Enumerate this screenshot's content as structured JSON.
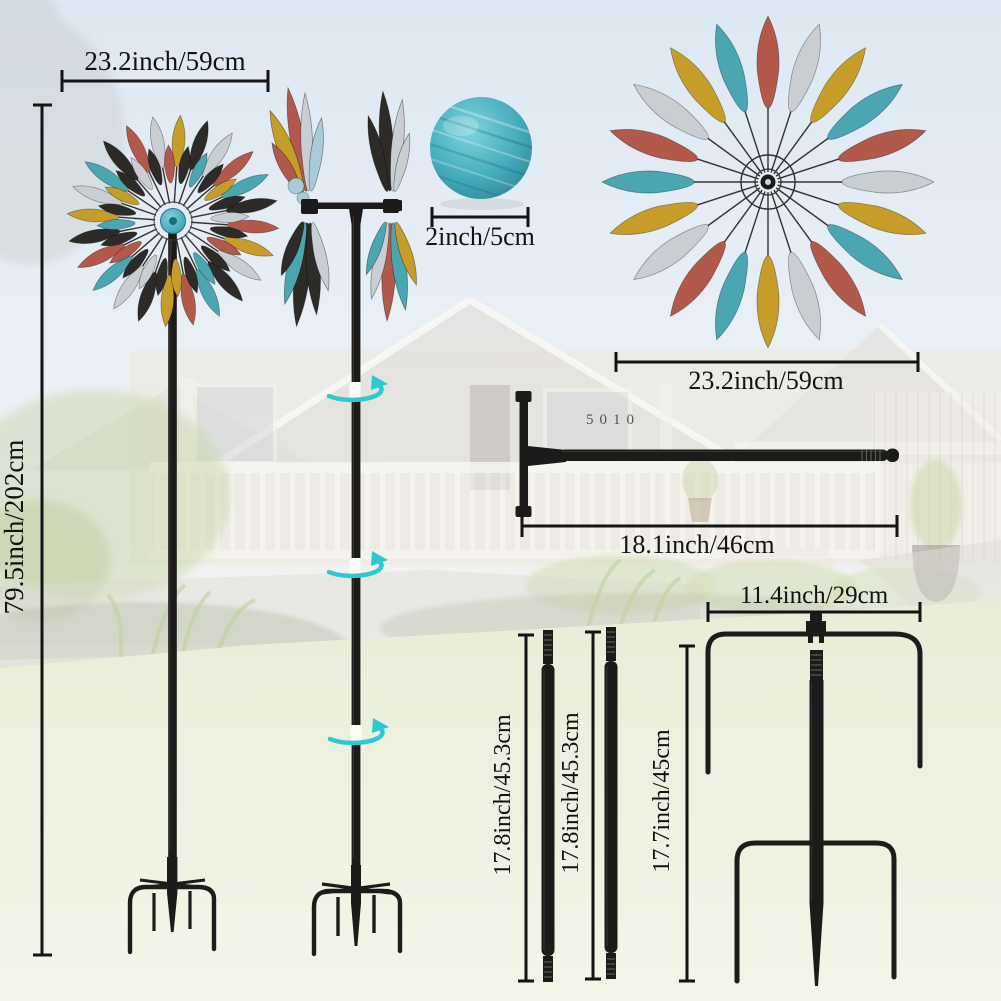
{
  "dims": {
    "left_width": "23.2inch/59cm",
    "total_height": "79.5inch/202cm",
    "ball": "2inch/5cm",
    "right_width": "23.2inch/59cm",
    "rod": "18.1inch/46cm",
    "stake_width": "11.4inch/29cm",
    "pole_a": "17.8inch/45.3cm",
    "pole_b": "17.8inch/45.3cm",
    "stake_height": "17.7inch/45cm"
  },
  "background": {
    "house_number": "5010"
  },
  "colors": {
    "petal_red": "#b2594b",
    "petal_teal": "#4aa7b2",
    "petal_gold": "#c79d2a",
    "petal_silver": "#c9ced3",
    "petal_black": "#2d2b28",
    "petal_lightblue": "#a9cbd8",
    "hub_teal": "#3eafc3",
    "ball_teal": "#3ba7b8",
    "rotation_arrow_cyan": "#2cc8d4",
    "metal_black": "#1c1b19",
    "dimension_black": "#141414"
  },
  "spinners": {
    "left": {
      "cx": 173,
      "cy": 221,
      "rings": [
        {
          "count": 24,
          "start": 4,
          "tip": 106,
          "len": 52,
          "w": 7.5,
          "spoke_inner": 18,
          "spoke_outer": 100,
          "colors": [
            "gold",
            "black",
            "silver",
            "red",
            "teal",
            "black",
            "red",
            "gold",
            "silver",
            "black",
            "teal",
            "red",
            "gold",
            "black",
            "silver",
            "teal",
            "red",
            "black",
            "gold",
            "silver",
            "teal",
            "black",
            "red",
            "silver"
          ]
        },
        {
          "count": 24,
          "start": 11.5,
          "tip": 76,
          "len": 38,
          "w": 6,
          "spoke_inner": 0,
          "spoke_outer": 0,
          "colors": [
            "black",
            "teal",
            "black",
            "gold",
            "black",
            "silver",
            "black",
            "red",
            "black",
            "teal",
            "black",
            "gold",
            "black",
            "silver",
            "black",
            "red",
            "black",
            "teal",
            "black",
            "gold",
            "black",
            "silver",
            "black",
            "red"
          ]
        }
      ]
    },
    "right": {
      "cx": 768,
      "cy": 182,
      "rings": [
        {
          "count": 20,
          "start": 0,
          "tip": 166,
          "len": 92,
          "w": 13,
          "spoke_inner": 10,
          "spoke_outer": 158,
          "colors": [
            "red",
            "silver",
            "gold",
            "teal"
          ]
        }
      ]
    }
  },
  "side_rotors": [
    {
      "cx": 309,
      "cy": 207,
      "leaves": [
        {
          "a": -10,
          "l": 105,
          "w": 8,
          "c": "red"
        },
        {
          "a": -22,
          "l": 88,
          "w": 9,
          "c": "gold"
        },
        {
          "a": -2,
          "l": 98,
          "w": 7,
          "c": "silver"
        },
        {
          "a": 8,
          "l": 74,
          "w": 7,
          "c": "lightblue"
        },
        {
          "a": -30,
          "l": 58,
          "w": 7,
          "c": "red"
        },
        {
          "a": 186,
          "l": 104,
          "w": 9,
          "c": "black"
        },
        {
          "a": 176,
          "l": 92,
          "w": 8,
          "c": "black"
        },
        {
          "a": 194,
          "l": 84,
          "w": 8,
          "c": "teal"
        },
        {
          "a": 167,
          "l": 70,
          "w": 7,
          "c": "silver"
        },
        {
          "a": 202,
          "l": 58,
          "w": 7,
          "c": "black"
        }
      ],
      "dots": [
        {
          "x": 296,
          "y": 186,
          "r": 8
        },
        {
          "x": 303,
          "y": 198,
          "r": 6
        }
      ]
    },
    {
      "cx": 391,
      "cy": 207,
      "leaves": [
        {
          "a": -4,
          "l": 100,
          "w": 8,
          "c": "black"
        },
        {
          "a": 6,
          "l": 92,
          "w": 7,
          "c": "silver"
        },
        {
          "a": -14,
          "l": 78,
          "w": 7,
          "c": "black"
        },
        {
          "a": 14,
          "l": 60,
          "w": 6,
          "c": "silver"
        },
        {
          "a": 182,
          "l": 98,
          "w": 8,
          "c": "red"
        },
        {
          "a": 172,
          "l": 88,
          "w": 8,
          "c": "teal"
        },
        {
          "a": 192,
          "l": 78,
          "w": 7,
          "c": "silver"
        },
        {
          "a": 162,
          "l": 66,
          "w": 7,
          "c": "gold"
        },
        {
          "a": 200,
          "l": 56,
          "w": 6,
          "c": "teal"
        }
      ],
      "dots": []
    }
  ],
  "rotation_arrows": [
    {
      "cx": 355,
      "cy": 391
    },
    {
      "cx": 355,
      "cy": 567
    },
    {
      "cx": 356,
      "cy": 734
    }
  ]
}
